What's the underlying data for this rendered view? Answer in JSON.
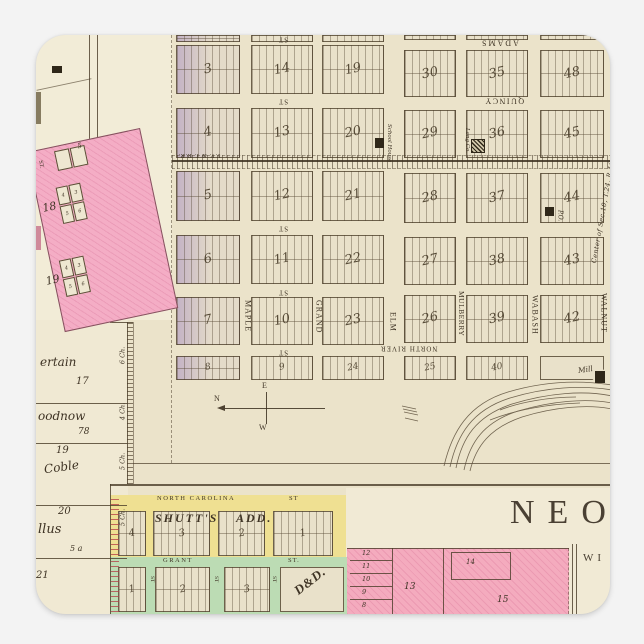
{
  "palette": {
    "outer_bg": "#f3f3f3",
    "paper": "#ebe3ca",
    "ink": "#43382a",
    "pink": "#f4abbe",
    "pink_nw": "#f4adc5",
    "yellow": "#efe092",
    "green": "#bcdcb4",
    "purple_tint": "#9678be"
  },
  "title": {
    "neo": "NEO",
    "wi": "WI"
  },
  "corner_note": "Center of Sec.10, T.24, R.16",
  "railroad_label": "Y.V. & I. R.R.",
  "compass": {
    "n": "N",
    "e": "E",
    "w": "W"
  },
  "grid_blocks": [
    {
      "n": "",
      "x": 176,
      "y": 35,
      "w": 64,
      "h": 7,
      "t": 1
    },
    {
      "n": "",
      "x": 251,
      "y": 35,
      "w": 62,
      "h": 7
    },
    {
      "n": "",
      "x": 322,
      "y": 35,
      "w": 62,
      "h": 7
    },
    {
      "n": "",
      "x": 404,
      "y": 35,
      "w": 52,
      "h": 5
    },
    {
      "n": "",
      "x": 466,
      "y": 35,
      "w": 62,
      "h": 5
    },
    {
      "n": "",
      "x": 540,
      "y": 35,
      "w": 64,
      "h": 5
    },
    {
      "n": "3",
      "x": 176,
      "y": 45,
      "w": 64,
      "h": 49,
      "t": 1
    },
    {
      "n": "4",
      "x": 176,
      "y": 108,
      "w": 64,
      "h": 50,
      "t": 1
    },
    {
      "n": "5",
      "x": 176,
      "y": 171,
      "w": 64,
      "h": 50,
      "t": 1
    },
    {
      "n": "6",
      "x": 176,
      "y": 235,
      "w": 64,
      "h": 49,
      "t": 1
    },
    {
      "n": "7",
      "x": 176,
      "y": 297,
      "w": 64,
      "h": 48,
      "t": 1
    },
    {
      "n": "8",
      "x": 176,
      "y": 356,
      "w": 64,
      "h": 24,
      "t": 1
    },
    {
      "n": "14",
      "x": 251,
      "y": 45,
      "w": 62,
      "h": 49
    },
    {
      "n": "13",
      "x": 251,
      "y": 108,
      "w": 62,
      "h": 50
    },
    {
      "n": "12",
      "x": 251,
      "y": 171,
      "w": 62,
      "h": 50
    },
    {
      "n": "11",
      "x": 251,
      "y": 235,
      "w": 62,
      "h": 49
    },
    {
      "n": "10",
      "x": 251,
      "y": 297,
      "w": 62,
      "h": 48
    },
    {
      "n": "9",
      "x": 251,
      "y": 356,
      "w": 62,
      "h": 24
    },
    {
      "n": "19",
      "x": 322,
      "y": 45,
      "w": 62,
      "h": 49
    },
    {
      "n": "20",
      "x": 322,
      "y": 108,
      "w": 62,
      "h": 50
    },
    {
      "n": "21",
      "x": 322,
      "y": 171,
      "w": 62,
      "h": 50
    },
    {
      "n": "22",
      "x": 322,
      "y": 235,
      "w": 62,
      "h": 49
    },
    {
      "n": "23",
      "x": 322,
      "y": 297,
      "w": 62,
      "h": 48
    },
    {
      "n": "24",
      "x": 322,
      "y": 356,
      "w": 62,
      "h": 24
    },
    {
      "n": "30",
      "x": 404,
      "y": 50,
      "w": 52,
      "h": 47
    },
    {
      "n": "29",
      "x": 404,
      "y": 110,
      "w": 52,
      "h": 48
    },
    {
      "n": "28",
      "x": 404,
      "y": 173,
      "w": 52,
      "h": 50
    },
    {
      "n": "27",
      "x": 404,
      "y": 237,
      "w": 52,
      "h": 48
    },
    {
      "n": "26",
      "x": 404,
      "y": 295,
      "w": 52,
      "h": 48
    },
    {
      "n": "25",
      "x": 404,
      "y": 356,
      "w": 52,
      "h": 24
    },
    {
      "n": "35",
      "x": 466,
      "y": 50,
      "w": 62,
      "h": 47
    },
    {
      "n": "36",
      "x": 466,
      "y": 110,
      "w": 62,
      "h": 48
    },
    {
      "n": "37",
      "x": 466,
      "y": 173,
      "w": 62,
      "h": 50
    },
    {
      "n": "38",
      "x": 466,
      "y": 237,
      "w": 62,
      "h": 48
    },
    {
      "n": "39",
      "x": 466,
      "y": 295,
      "w": 62,
      "h": 48
    },
    {
      "n": "40",
      "x": 466,
      "y": 356,
      "w": 62,
      "h": 24
    },
    {
      "n": "48",
      "x": 540,
      "y": 50,
      "w": 64,
      "h": 47
    },
    {
      "n": "45",
      "x": 540,
      "y": 110,
      "w": 64,
      "h": 48
    },
    {
      "n": "44",
      "x": 540,
      "y": 173,
      "w": 64,
      "h": 50
    },
    {
      "n": "43",
      "x": 540,
      "y": 237,
      "w": 64,
      "h": 48
    },
    {
      "n": "42",
      "x": 540,
      "y": 295,
      "w": 64,
      "h": 48
    }
  ],
  "street_labels": [
    {
      "t": "ST",
      "x": 278,
      "y": 35,
      "fs": 7,
      "rot": 180,
      "sp": 1
    },
    {
      "t": "ST",
      "x": 278,
      "y": 97,
      "fs": 7,
      "rot": 180,
      "sp": 1
    },
    {
      "t": "ST",
      "x": 278,
      "y": 224,
      "fs": 7,
      "rot": 180,
      "sp": 1
    },
    {
      "t": "ST",
      "x": 278,
      "y": 288,
      "fs": 7,
      "rot": 180,
      "sp": 1
    },
    {
      "t": "ST",
      "x": 278,
      "y": 348,
      "fs": 7,
      "rot": 180,
      "sp": 1
    },
    {
      "t": "ADAMS",
      "x": 480,
      "y": 38,
      "fs": 8,
      "rot": 180,
      "sp": 2
    },
    {
      "t": "QUINCY",
      "x": 484,
      "y": 96,
      "fs": 8,
      "rot": 180,
      "sp": 1.5
    },
    {
      "t": "NORTH RIVER",
      "x": 380,
      "y": 344,
      "fs": 7,
      "rot": 180,
      "sp": 1
    },
    {
      "t": "MAPLE",
      "x": 243,
      "y": 300,
      "fs": 8,
      "vert": 1,
      "sp": 1
    },
    {
      "t": "GRAND",
      "x": 314,
      "y": 300,
      "fs": 8,
      "vert": 1,
      "sp": 1
    },
    {
      "t": "ELM",
      "x": 388,
      "y": 312,
      "fs": 8,
      "vert": 1,
      "sp": 1
    },
    {
      "t": "MULBERRY",
      "x": 457,
      "y": 291,
      "fs": 7.5,
      "vert": 1,
      "sp": 0.5
    },
    {
      "t": "WABASH",
      "x": 530,
      "y": 295,
      "fs": 8,
      "vert": 1,
      "sp": 1
    },
    {
      "t": "WALNUT",
      "x": 599,
      "y": 293,
      "fs": 8,
      "vert": 1,
      "sp": 1
    }
  ],
  "pois": [
    {
      "t": "School House",
      "x": 385,
      "y": 124,
      "fs": 5.5,
      "vert": 1,
      "it": 1,
      "name": "school-house-label"
    },
    {
      "t": "Lang Co.",
      "x": 463,
      "y": 128,
      "fs": 5.5,
      "vert": 1,
      "it": 1,
      "name": "lang-co-label"
    },
    {
      "t": "P.O.",
      "x": 556,
      "y": 210,
      "fs": 6,
      "vert": 1,
      "it": 1,
      "name": "post-office-label"
    },
    {
      "t": "Mill",
      "x": 578,
      "y": 366,
      "fs": 7.5,
      "it": 1,
      "rot": -8,
      "name": "mill-label"
    }
  ],
  "parcels": {
    "labels": [
      {
        "t": "ertain",
        "x": 40,
        "y": 356,
        "fs": 12,
        "it": 1
      },
      {
        "t": "17",
        "x": 76,
        "y": 377,
        "fs": 10,
        "it": 1
      },
      {
        "t": "oodnow",
        "x": 38,
        "y": 410,
        "fs": 12,
        "it": 1
      },
      {
        "t": "78",
        "x": 78,
        "y": 428,
        "fs": 9,
        "it": 1
      },
      {
        "t": "19",
        "x": 56,
        "y": 446,
        "fs": 10,
        "it": 1
      },
      {
        "t": "Coble",
        "x": 44,
        "y": 461,
        "fs": 12,
        "it": 1,
        "rot": -8
      },
      {
        "t": "20",
        "x": 58,
        "y": 507,
        "fs": 10,
        "it": 1
      },
      {
        "t": "llus",
        "x": 38,
        "y": 523,
        "fs": 13,
        "it": 1
      },
      {
        "t": "5 a",
        "x": 70,
        "y": 545,
        "fs": 8,
        "it": 1
      },
      {
        "t": "21",
        "x": 36,
        "y": 571,
        "fs": 10,
        "it": 1
      }
    ],
    "chains": [
      {
        "t": "6 Ch.",
        "y": 352
      },
      {
        "t": "4 Ch.",
        "y": 408
      },
      {
        "t": "5 Ch.",
        "y": 458
      },
      {
        "t": "5 Ch.",
        "y": 514
      }
    ],
    "lines": [
      403,
      443,
      505,
      558
    ]
  },
  "nw": {
    "st": "ST.",
    "five": "5",
    "blocks": [
      {
        "n": "18"
      },
      {
        "n": "19"
      }
    ],
    "lot_numbers": [
      "4",
      "3",
      "5",
      "6"
    ]
  },
  "shutts": {
    "street": "NORTH CAROLINA",
    "st": "ST",
    "name": "SHUTT'S",
    "add": "ADD.",
    "blocks": [
      {
        "n": "4",
        "x": 118,
        "w": 28
      },
      {
        "n": "3",
        "x": 153,
        "w": 57
      },
      {
        "n": "2",
        "x": 218,
        "w": 47
      },
      {
        "n": "1",
        "x": 273,
        "w": 60
      }
    ]
  },
  "grant": {
    "street": "GRANT",
    "st": "ST.",
    "st_vertical": "ST",
    "dd": "D&D.",
    "blocks": [
      {
        "n": "1",
        "x": 118,
        "w": 28
      },
      {
        "n": "2",
        "x": 155,
        "w": 55
      },
      {
        "n": "3",
        "x": 224,
        "w": 46
      }
    ],
    "st_x": [
      148,
      212,
      270
    ]
  },
  "pink": {
    "stack": [
      "12",
      "11",
      "10",
      "9",
      "8"
    ],
    "l13": "13",
    "l14": "14",
    "l15": "15"
  }
}
